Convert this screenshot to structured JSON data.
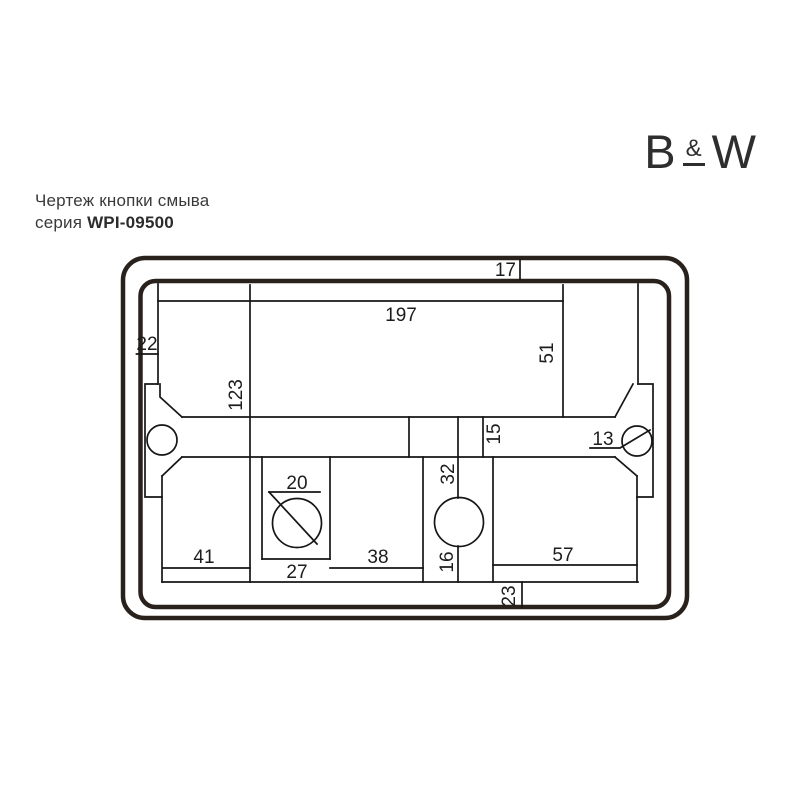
{
  "header": {
    "title": "Чертеж кнопки смыва",
    "series_label": "серия",
    "series_code": "WPI-09500"
  },
  "logo": {
    "b": "B",
    "amp": "&",
    "w": "W"
  },
  "drawing": {
    "dims": {
      "frame_top_offset": "17",
      "plate_width": "197",
      "frame_left_offset": "22",
      "top_to_bar": "51",
      "plate_height": "123",
      "bar_segment": "15",
      "mount_hole_dia": "13",
      "button_hole_dia": "20",
      "button_cell_width": "27",
      "cell_gap": "38",
      "center_width": "32",
      "center_half_width": "16",
      "left_cell_width": "41",
      "right_cell_width": "57",
      "bottom_offset": "23"
    },
    "colors": {
      "frame_stroke": "#29211b",
      "line_stroke": "#161616",
      "label": "#1d1d1d"
    }
  }
}
